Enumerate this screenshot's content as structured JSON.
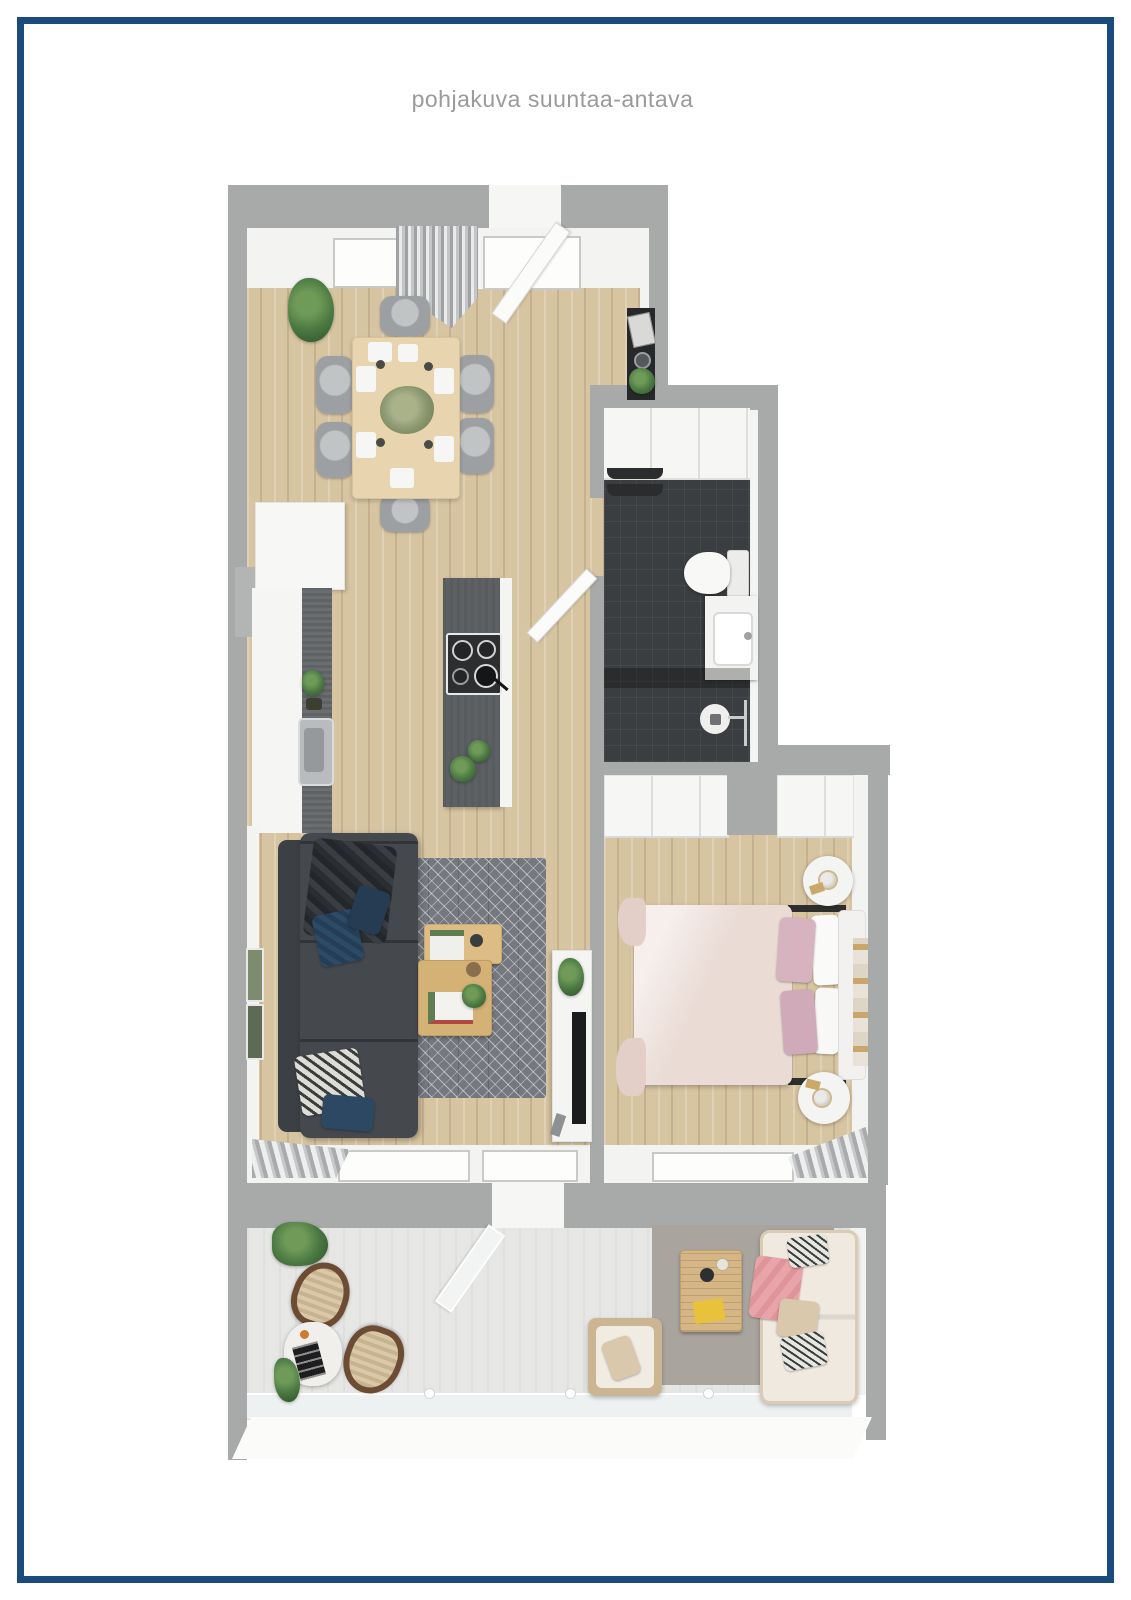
{
  "title": {
    "text": "pohjakuva suuntaa-antava"
  },
  "palette": {
    "navy": "#1b4a7d",
    "title-gray": "#9a9a9a",
    "wall": "#a8a9a9",
    "face": "#f3f3f1",
    "wood": "#d7c4a1",
    "bath": "#3b3e40",
    "island": "#5d6163",
    "rug": "#75797f",
    "sofa": "#45484d",
    "bed": "#eadbd5",
    "pink": "#d7b3bf",
    "green": "#4c7a43",
    "chair": "#9da0a2",
    "balcony": "#e6e6e4",
    "out-rug": "#aaa49e",
    "table-wood": "#e8d5b0"
  }
}
